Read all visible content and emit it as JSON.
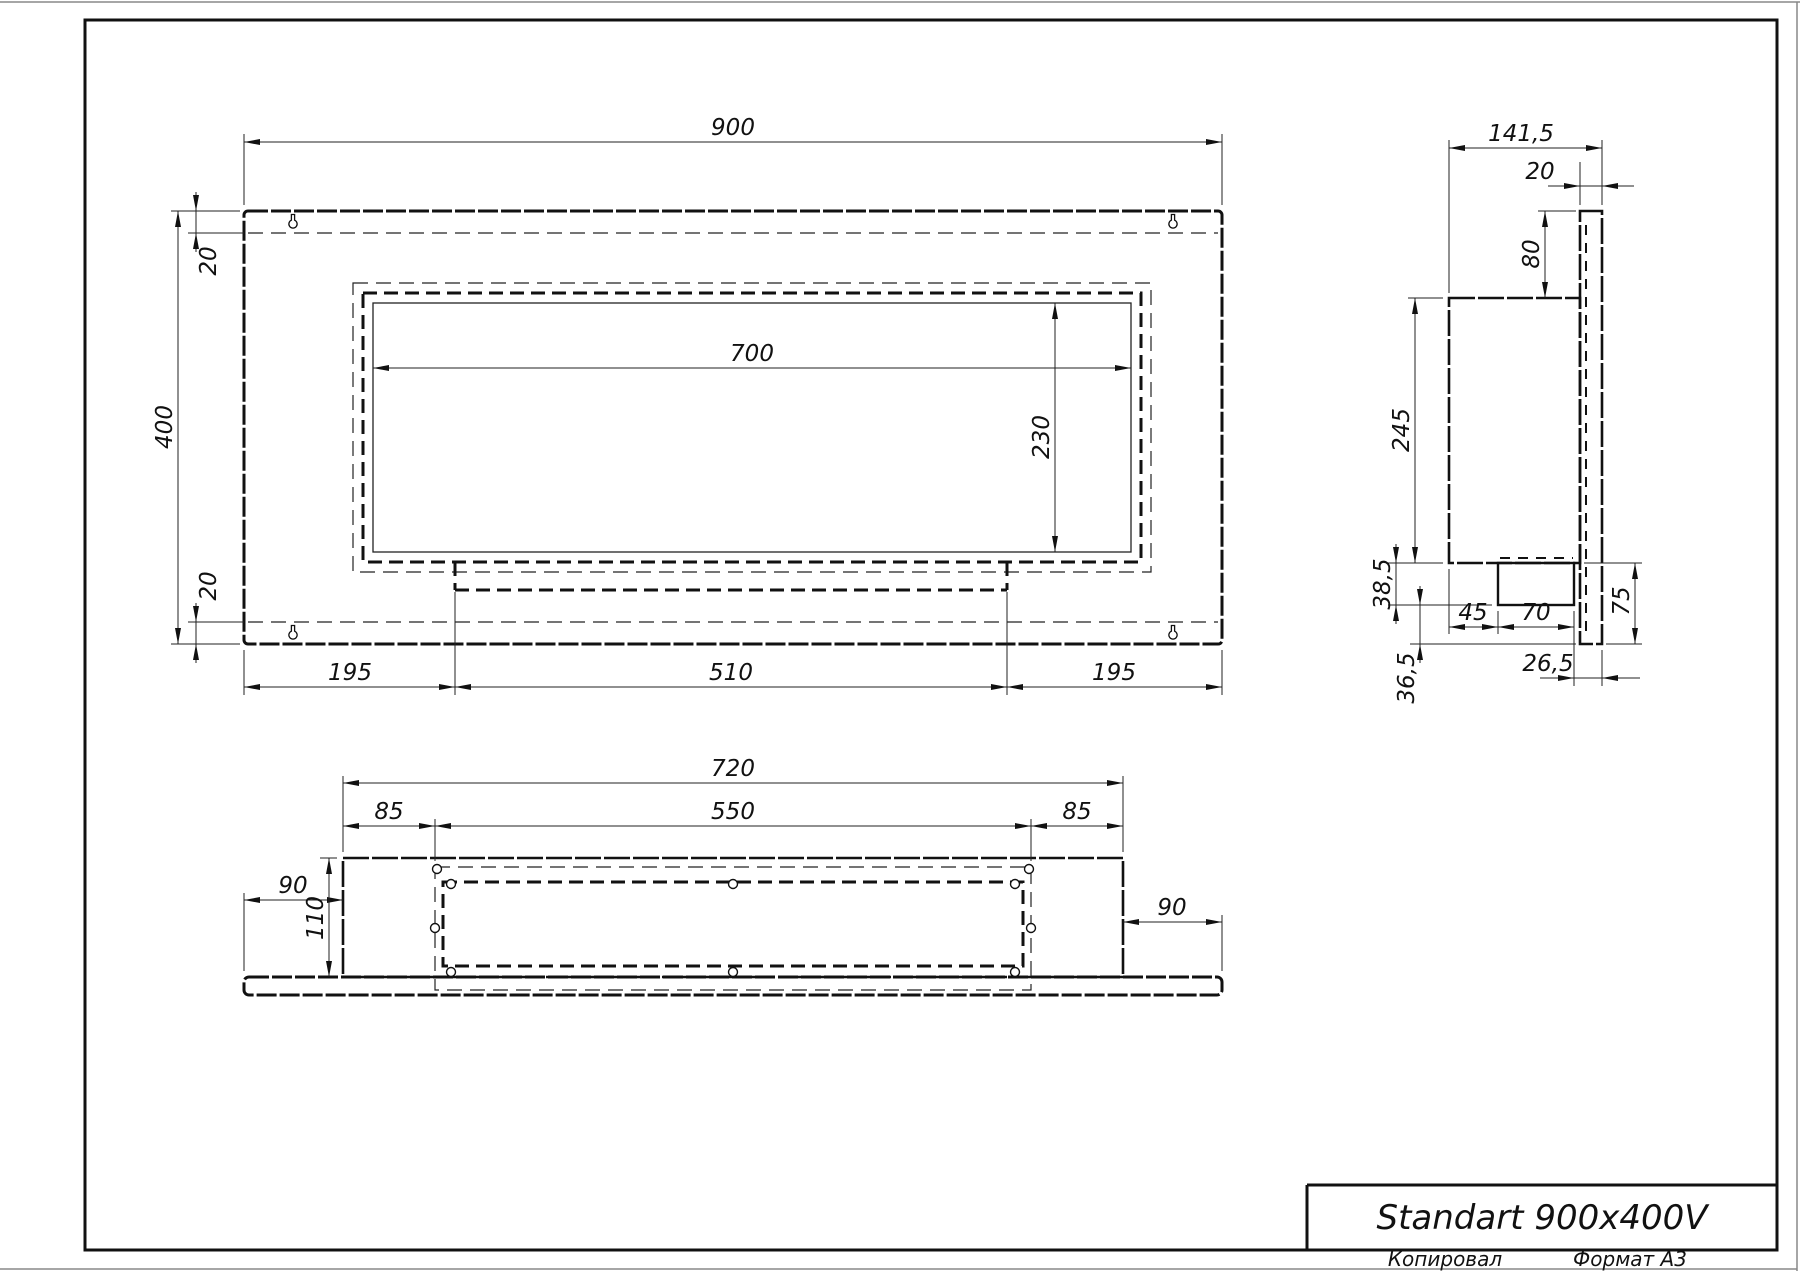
{
  "title_block": {
    "title": "Standart 900x400V"
  },
  "footer": {
    "copied_label": "Копировал",
    "format_label": "Формат A3"
  },
  "front_view": {
    "width": "900",
    "height": "400",
    "top_offset": "20",
    "bottom_offset": "20",
    "opening_width": "700",
    "opening_height": "230",
    "left_margin": "195",
    "burner_width": "510",
    "right_margin": "195"
  },
  "side_view": {
    "total_depth": "141,5",
    "panel_thickness": "20",
    "top_flange": "80",
    "body_height": "245",
    "tray_drop": "38,5",
    "tray_bottom_to_panel": "36,5",
    "tray_offset": "45",
    "tray_depth": "70",
    "tray_to_panel_edge": "26,5",
    "bottom_flange": "75"
  },
  "bottom_view": {
    "body_width": "720",
    "slot_width": "550",
    "slot_left_inset": "85",
    "slot_right_inset": "85",
    "panel_left_overhang": "90",
    "panel_right_overhang": "90",
    "body_depth": "110"
  },
  "icons": {
    "keyhole": "keyhole-mounting-slot",
    "hole": "mounting-hole"
  },
  "colors": {
    "line": "#111111",
    "paper": "#ffffff"
  }
}
